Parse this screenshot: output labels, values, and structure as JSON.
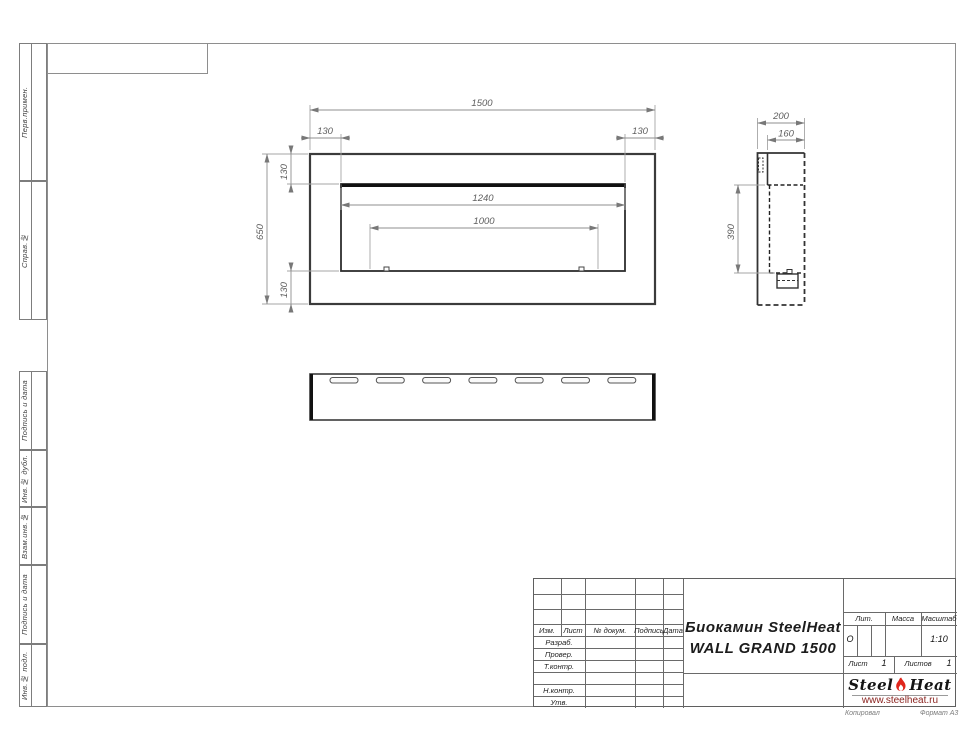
{
  "sidebar": {
    "items": [
      "Перв.примен.",
      "Справ.№",
      "Подпись и дата",
      "Инв.№ дубл.",
      "Взам.инв.№",
      "Подпись и дата",
      "Инв.№ подл."
    ]
  },
  "title_block": {
    "revision_header": [
      "Изм.",
      "Лист",
      "№ докум.",
      "Подпись",
      "Дата"
    ],
    "approval_rows": [
      "Разраб.",
      "Провер.",
      "Т.контр.",
      "",
      "Н.контр.",
      "Утв."
    ],
    "doc_title_line1": "Биокамин SteelHeat",
    "doc_title_line2": "WALL GRAND 1500",
    "lit_label": "Лит.",
    "lit_value": "О",
    "mass_label": "Масса",
    "scale_label": "Масштаб",
    "scale_value": "1:10",
    "sheet_label": "Лист",
    "sheet_value": "1",
    "sheets_label": "Листов",
    "sheets_value": "1",
    "logo_steel": "Steel",
    "logo_heat": "Heat",
    "logo_url": "www.steelheat.ru",
    "footer_copied": "Копировал",
    "footer_format": "Формат А3"
  },
  "drawing": {
    "dims": {
      "total_width": "1500",
      "flange_left": "130",
      "flange_right": "130",
      "total_height": "650",
      "flange_top": "130",
      "flange_bottom": "130",
      "opening_width": "1240",
      "burner_length": "1000",
      "depth": "200",
      "depth_inner": "160",
      "side_height": "390"
    }
  },
  "colors": {
    "flame_red": "#e0261c",
    "url_red": "#8b2420",
    "outline": "#3b3b3b",
    "dim_gray": "#8f8f8f"
  }
}
